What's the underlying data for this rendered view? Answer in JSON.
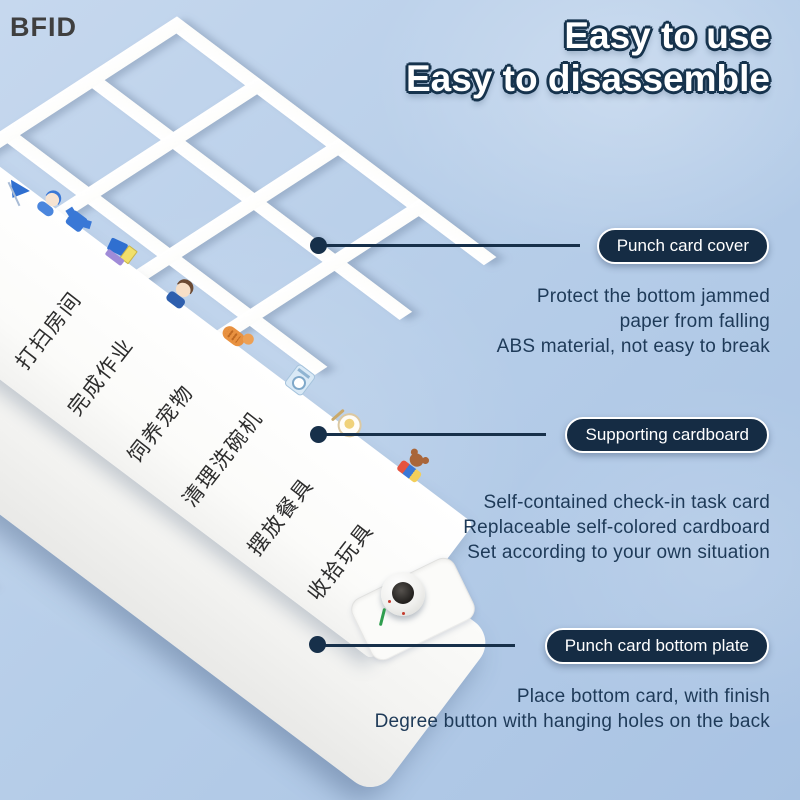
{
  "watermark": "BFID",
  "title": {
    "line1": "Easy to use",
    "line2": "Easy to disassemble"
  },
  "callouts": [
    {
      "label": "Punch card cover",
      "description": "Protect the bottom jammed\npaper from falling\nABS material, not easy to break"
    },
    {
      "label": "Supporting cardboard",
      "description": "Self-contained check-in task card\nReplaceable self-colored cardboard\nSet according to your own situation"
    },
    {
      "label": "Punch card bottom plate",
      "description": "Place bottom card, with finish\nDegree button with hanging holes on the back"
    }
  ],
  "card": {
    "tasks": [
      "打扫房间",
      "完成作业",
      "饲养宠物",
      "清理洗碗机",
      "摆放餐具",
      "收拾玩具"
    ]
  },
  "stickers": [
    "broom-flag-sticker",
    "headphone-person-sticker",
    "shirt-sticker",
    "dustpan-books-sticker",
    "boy-sticker",
    "cat-sticker",
    "washing-machine-sticker",
    "plate-cutlery-sticker",
    "teddy-toys-sticker"
  ],
  "colors": {
    "background": "#b7cee9",
    "navy": "#17304a",
    "pill_bg": "#152c44",
    "description_text": "#1e3a58",
    "title_fill": "#ffffff",
    "title_outline": "#16334d",
    "card_text": "#2d2d2d",
    "green_mark": "#2f9e4f",
    "watermark_text": "#3f3f3f"
  }
}
